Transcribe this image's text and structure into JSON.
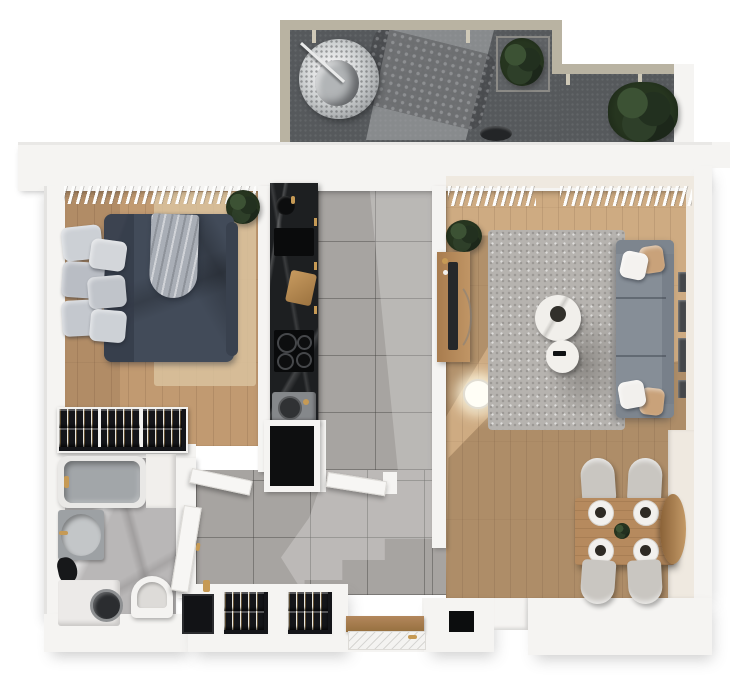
{
  "scene": {
    "type": "apartment-floor-plan-3d-top-view",
    "canvas_width": 750,
    "canvas_height": 680,
    "background_color": "#ffffff",
    "visible_text": []
  },
  "palette": {
    "wall_white": "#f5f4f2",
    "wall_inner_cream": "#efe9e0",
    "balcony_concrete": "#56595c",
    "balcony_rail_tan": "#b9b3a2",
    "wood_floor_bedroom": "#c19a71",
    "wood_floor_living": "#ceab82",
    "wood_furniture": "#b3875c",
    "tile_gray": "#a7a4a1",
    "bath_marble_gray": "#b9b7b7",
    "kitchen_marble_black": "#1d1f21",
    "bed_duvet_navy": "#424b59",
    "pillow_gray": "#c6cad0",
    "sofa_gray": "#868e97",
    "living_rug_gray": "#b6b3af",
    "bedroom_rug_beige": "#d9c29e",
    "plant_green": "#2e3b2a",
    "accent_gold": "#c69a55",
    "dark_fixture": "#141517"
  },
  "rooms": {
    "balcony": {
      "label": "Balcony terrace",
      "items": [
        "railing-tan",
        "hanging-egg-chair",
        "chair-shadow",
        "planter-box",
        "potted-bush",
        "outdoor-speaker"
      ]
    },
    "bedroom": {
      "label": "Bedroom",
      "items": [
        "window-blinds",
        "double-bed",
        "duvet-navy",
        "throw-blanket",
        "area-rug-beige",
        "potted-plant",
        "open-wardrobe"
      ],
      "pillow_count": 6,
      "wardrobe_sections": 3
    },
    "kitchen": {
      "label": "Kitchen",
      "items": [
        "black-marble-counter",
        "round-sink",
        "serving-tray",
        "cutting-board",
        "induction-cooktop",
        "coffee-machine",
        "tall-black-cabinet"
      ],
      "burner_count": 4
    },
    "bathroom": {
      "label": "Bathroom",
      "items": [
        "bathtub",
        "corner-shelf",
        "vanity-sink",
        "bathrobe",
        "washing-machine",
        "toilet",
        "open-door"
      ]
    },
    "hallway": {
      "label": "Entrance hallway",
      "items": [
        "gray-floor-tiles",
        "open-door-bedroom",
        "open-door-corridor",
        "full-length-mirror",
        "built-in-wardrobe-left",
        "built-in-wardrobe-right",
        "entrance-door",
        "wall-niche"
      ],
      "wardrobe_count": 2
    },
    "living_room": {
      "label": "Living room",
      "items": [
        "window-blinds",
        "tv-sideboard",
        "tv",
        "floor-lamp",
        "potted-plant",
        "area-rug-gray",
        "round-coffee-table-large",
        "round-coffee-table-small",
        "sofa",
        "throw-pillows",
        "wall-frames",
        "dining-table",
        "dining-chairs",
        "table-settings",
        "round-wall-mirror"
      ],
      "dining_chair_count": 4,
      "place_setting_count": 4,
      "wall_frame_count": 4,
      "sofa_seat_count": 3
    }
  }
}
